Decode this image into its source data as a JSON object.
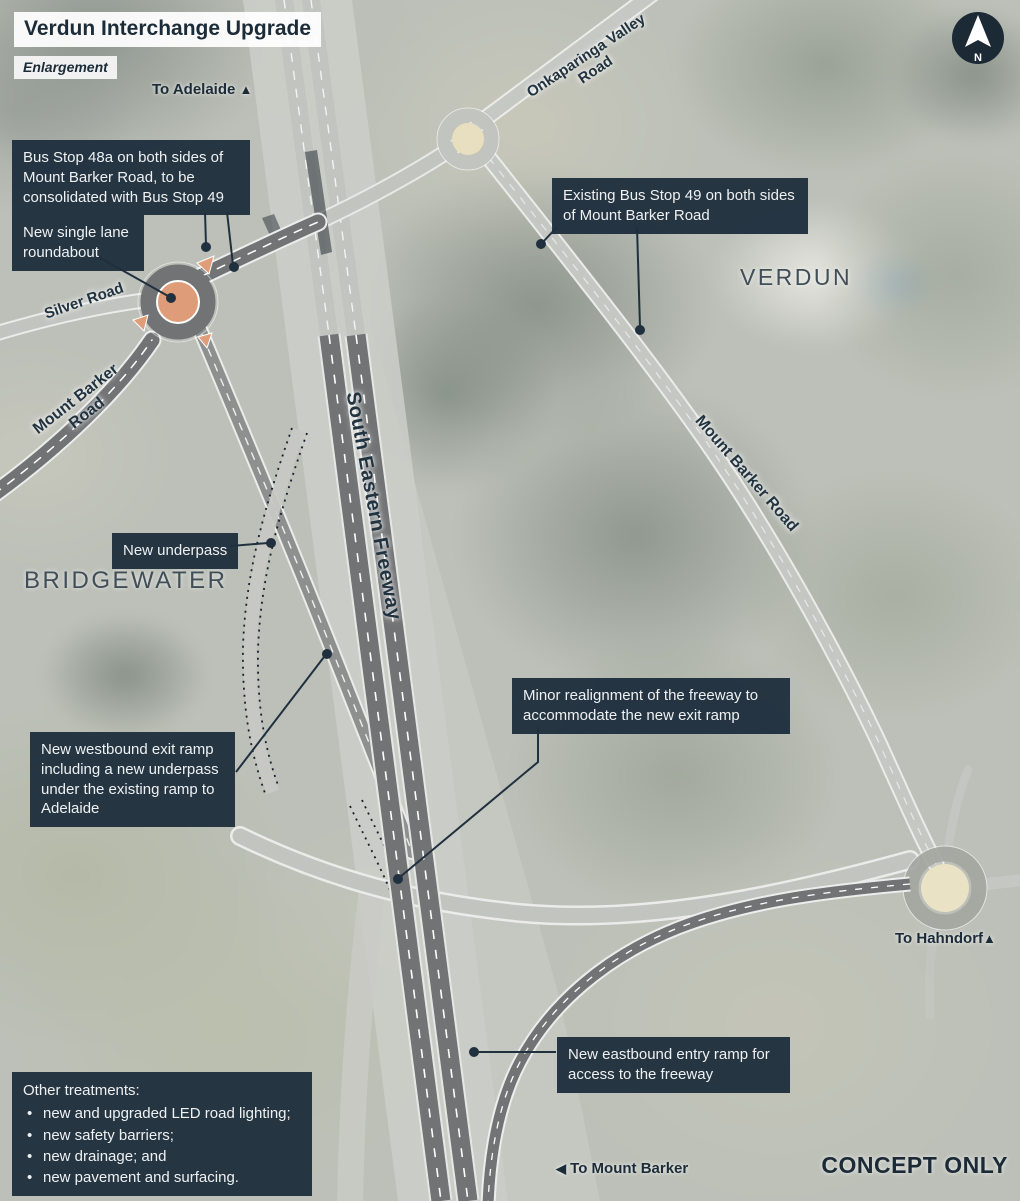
{
  "title": "Verdun Interchange Upgrade",
  "subtitle": "Enlargement",
  "compass_label": "N",
  "watermark": "CONCEPT ONLY",
  "direction_labels": {
    "adelaide": "To Adelaide",
    "adelaide_arrow": "▲",
    "hahndorf": "To Hahndorf",
    "hahndorf_arrow": "▲",
    "mount_barker": "To Mount Barker",
    "mount_barker_arrow": "◀"
  },
  "place_labels": {
    "verdun": "VERDUN",
    "bridgewater": "BRIDGEWATER"
  },
  "road_labels": {
    "onkaparinga": "Onkaparinga Valley Road",
    "silver_road": "Silver Road",
    "mount_barker_west": "Mount Barker Road",
    "mount_barker_east": "Mount Barker Road",
    "freeway": "South Eastern Freeway"
  },
  "callouts": {
    "bus_stop_48a": "Bus Stop 48a on both sides of Mount Barker Road, to be consolidated with Bus Stop 49",
    "new_roundabout": "New single lane roundabout",
    "bus_stop_49": "Existing Bus Stop 49 on both sides of Mount Barker Road",
    "new_underpass": "New underpass",
    "westbound_exit_ramp": "New westbound exit ramp including a new underpass under the existing ramp to Adelaide",
    "freeway_realignment": "Minor realignment of the freeway to accommodate the new exit ramp",
    "eastbound_entry_ramp": "New eastbound entry ramp for access to the freeway"
  },
  "other_treatments": {
    "heading": "Other treatments:",
    "items": [
      "new and upgraded LED road lighting;",
      "new safety barriers;",
      "new drainage; and",
      "new pavement and surfacing."
    ]
  },
  "colors": {
    "callout_bg": "#1f2f3d",
    "callout_text": "#eef1f2",
    "label_navy": "#1c2b38",
    "new_road": "#717375",
    "existing_road": "#c2c4c0",
    "roundabout_fill": "#df9c78",
    "roundabout_island": "#e09d79",
    "existing_roundabout_fill": "#e9e2c5",
    "leader_line": "#20303e"
  }
}
